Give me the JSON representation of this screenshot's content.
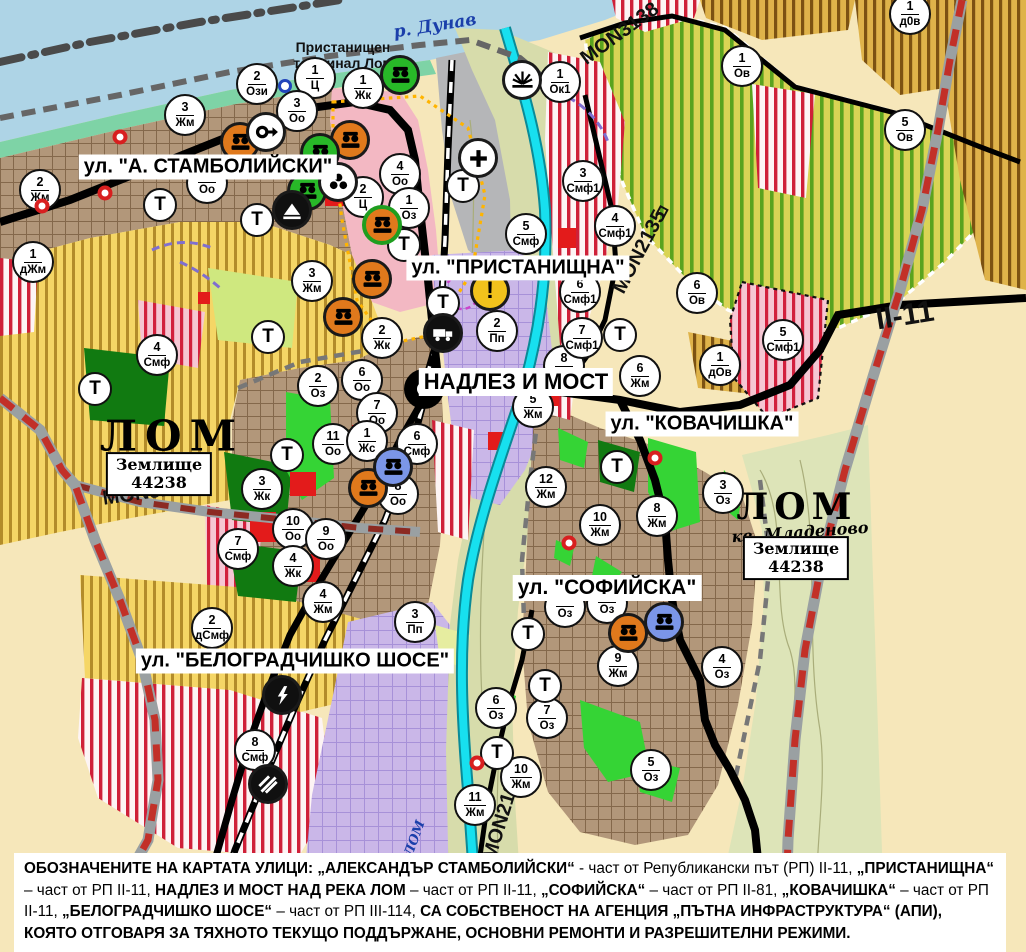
{
  "map": {
    "street_labels": [
      {
        "text": "ул. \"А. СТАМБОЛИЙСКИ\"",
        "x": 208,
        "y": 167
      },
      {
        "text": "ул. \"ПРИСТАНИЩНА\"",
        "x": 518,
        "y": 268
      },
      {
        "text": "НАДЛЕЗ И МОСТ",
        "x": 516,
        "y": 382
      },
      {
        "text": "ул. \"КОВАЧИШКА\"",
        "x": 702,
        "y": 424
      },
      {
        "text": "ул. \"СОФИЙСКА\"",
        "x": 607,
        "y": 588
      },
      {
        "text": "ул. \"БЕЛОГРАДЧИШКО ШОСЕ\"",
        "x": 295,
        "y": 661
      }
    ],
    "labels": [
      {
        "text": "р. Дунав",
        "x": 435,
        "y": 26,
        "cls": "river",
        "rot": -9,
        "size": 17
      },
      {
        "text": "Пристанищен\nтерминал Лом",
        "x": 343,
        "y": 55,
        "cls": "",
        "rot": 0,
        "size": 14
      },
      {
        "text": "ЛОМ",
        "x": 172,
        "y": 436,
        "cls": "city",
        "rot": 0,
        "size": 42,
        "ls": 8
      },
      {
        "text": "MON3139",
        "x": 148,
        "y": 493,
        "cls": "",
        "rot": -8,
        "size": 20
      },
      {
        "text": "MON3138",
        "x": 620,
        "y": 34,
        "cls": "",
        "rot": -36,
        "size": 20
      },
      {
        "text": "MON2135",
        "x": 640,
        "y": 252,
        "cls": "",
        "rot": -62,
        "size": 20
      },
      {
        "text": "⊓",
        "x": 662,
        "y": 212,
        "cls": "",
        "rot": 28,
        "size": 16
      },
      {
        "text": "II-11",
        "x": 905,
        "y": 316,
        "cls": "",
        "rot": -9,
        "size": 30
      },
      {
        "text": "ЛОМ",
        "x": 797,
        "y": 507,
        "cls": "city",
        "rot": 0,
        "size": 36,
        "ls": 6
      },
      {
        "text": "кв. Младеново",
        "x": 800,
        "y": 532,
        "cls": "city-sub",
        "rot": -4,
        "size": 16
      },
      {
        "text": "MON2136",
        "x": 503,
        "y": 816,
        "cls": "",
        "rot": -73,
        "size": 20
      },
      {
        "text": "р. ЛОМ",
        "x": 412,
        "y": 847,
        "cls": "river",
        "rot": -70,
        "size": 13
      }
    ],
    "land_boxes": [
      {
        "text": "Землище\n44238",
        "x": 159,
        "y": 474
      },
      {
        "text": "Землище\n44238",
        "x": 796,
        "y": 558
      }
    ],
    "t_label": "Т",
    "zone_markers": [
      {
        "num": "2",
        "code": "Жм",
        "x": 40,
        "y": 190
      },
      {
        "num": "3",
        "code": "Жм",
        "x": 185,
        "y": 115
      },
      {
        "num": "2",
        "code": "Ози",
        "x": 257,
        "y": 84
      },
      {
        "num": "1",
        "code": "Ц",
        "x": 315,
        "y": 78
      },
      {
        "num": "3",
        "code": "Оо",
        "x": 297,
        "y": 111
      },
      {
        "num": "1",
        "code": "Жк",
        "x": 363,
        "y": 88
      },
      {
        "num": "1",
        "code": "дЖм",
        "x": 33,
        "y": 262
      },
      {
        "num": "4",
        "code": "Оо",
        "x": 400,
        "y": 174
      },
      {
        "num": "2",
        "code": "Ц",
        "x": 363,
        "y": 197
      },
      {
        "num": "1",
        "code": "Оз",
        "x": 409,
        "y": 208
      },
      {
        "num": "",
        "code": "Оо",
        "x": 207,
        "y": 183,
        "under": true
      },
      {
        "num": "4",
        "code": "Смф",
        "x": 157,
        "y": 355
      },
      {
        "num": "3",
        "code": "Жм",
        "x": 312,
        "y": 281
      },
      {
        "num": "2",
        "code": "Жк",
        "x": 382,
        "y": 338
      },
      {
        "num": "2",
        "code": "Оз",
        "x": 318,
        "y": 386
      },
      {
        "num": "6",
        "code": "Оо",
        "x": 362,
        "y": 380
      },
      {
        "num": "7",
        "code": "Оо",
        "x": 377,
        "y": 413
      },
      {
        "num": "11",
        "code": "Оо",
        "x": 333,
        "y": 444
      },
      {
        "num": "1",
        "code": "Жс",
        "x": 367,
        "y": 441
      },
      {
        "num": "6",
        "code": "Смф",
        "x": 417,
        "y": 444
      },
      {
        "num": "3",
        "code": "Жк",
        "x": 262,
        "y": 489
      },
      {
        "num": "8",
        "code": "Оо",
        "x": 398,
        "y": 494
      },
      {
        "num": "10",
        "code": "Оо",
        "x": 293,
        "y": 529
      },
      {
        "num": "9",
        "code": "Оо",
        "x": 326,
        "y": 539
      },
      {
        "num": "7",
        "code": "Смф",
        "x": 238,
        "y": 549
      },
      {
        "num": "4",
        "code": "Жк",
        "x": 293,
        "y": 566
      },
      {
        "num": "4",
        "code": "Жм",
        "x": 323,
        "y": 602
      },
      {
        "num": "2",
        "code": "дСмф",
        "x": 212,
        "y": 628
      },
      {
        "num": "3",
        "code": "Пп",
        "x": 415,
        "y": 622
      },
      {
        "num": "8",
        "code": "Смф",
        "x": 255,
        "y": 750
      },
      {
        "num": "2",
        "code": "Пп",
        "x": 497,
        "y": 331
      },
      {
        "num": "5",
        "code": "Смф",
        "x": 526,
        "y": 234
      },
      {
        "num": "1",
        "code": "Ок1",
        "x": 560,
        "y": 82
      },
      {
        "num": "3",
        "code": "Смф1",
        "x": 583,
        "y": 181
      },
      {
        "num": "4",
        "code": "Смф1",
        "x": 615,
        "y": 226
      },
      {
        "num": "6",
        "code": "Смф1",
        "x": 580,
        "y": 292
      },
      {
        "num": "7",
        "code": "Смф1",
        "x": 582,
        "y": 338
      },
      {
        "num": "1",
        "code": "Ов",
        "x": 742,
        "y": 66
      },
      {
        "num": "5",
        "code": "Ов",
        "x": 905,
        "y": 130
      },
      {
        "num": "1",
        "code": "д0в",
        "x": 910,
        "y": 14
      },
      {
        "num": "6",
        "code": "Ов",
        "x": 697,
        "y": 293
      },
      {
        "num": "5",
        "code": "Смф1",
        "x": 783,
        "y": 340
      },
      {
        "num": "1",
        "code": "дОв",
        "x": 720,
        "y": 365
      },
      {
        "num": "8",
        "code": "Жм",
        "x": 564,
        "y": 366,
        "under": true
      },
      {
        "num": "5",
        "code": "Жм",
        "x": 533,
        "y": 407
      },
      {
        "num": "6",
        "code": "Жм",
        "x": 640,
        "y": 376
      },
      {
        "num": "12",
        "code": "Жм",
        "x": 546,
        "y": 487
      },
      {
        "num": "10",
        "code": "Жм",
        "x": 600,
        "y": 525
      },
      {
        "num": "8",
        "code": "Жм",
        "x": 657,
        "y": 516
      },
      {
        "num": "3",
        "code": "Оз",
        "x": 723,
        "y": 493
      },
      {
        "num": "9",
        "code": "Жм",
        "x": 618,
        "y": 666
      },
      {
        "num": "4",
        "code": "Оз",
        "x": 722,
        "y": 667
      },
      {
        "num": "6",
        "code": "Оз",
        "x": 496,
        "y": 708
      },
      {
        "num": "7",
        "code": "Оз",
        "x": 547,
        "y": 718
      },
      {
        "num": "5",
        "code": "Оз",
        "x": 651,
        "y": 770
      },
      {
        "num": "10",
        "code": "Жм",
        "x": 521,
        "y": 777
      },
      {
        "num": "11",
        "code": "Жм",
        "x": 475,
        "y": 805
      },
      {
        "num": "",
        "code": "Оз",
        "x": 565,
        "y": 607,
        "under": true
      },
      {
        "num": "",
        "code": "Оз",
        "x": 607,
        "y": 603,
        "under": true
      }
    ],
    "t_markers": [
      {
        "x": 160,
        "y": 205
      },
      {
        "x": 95,
        "y": 389
      },
      {
        "x": 257,
        "y": 220
      },
      {
        "x": 404,
        "y": 245
      },
      {
        "x": 268,
        "y": 337
      },
      {
        "x": 287,
        "y": 455
      },
      {
        "x": 443,
        "y": 303
      },
      {
        "x": 620,
        "y": 335
      },
      {
        "x": 463,
        "y": 186
      },
      {
        "x": 617,
        "y": 467
      },
      {
        "x": 528,
        "y": 634
      },
      {
        "x": 545,
        "y": 686
      },
      {
        "x": 497,
        "y": 753
      }
    ],
    "poi": [
      {
        "type": "monument-orange",
        "x": 240,
        "y": 142
      },
      {
        "type": "monument-orange",
        "x": 350,
        "y": 140
      },
      {
        "type": "monument-orange",
        "x": 372,
        "y": 279
      },
      {
        "type": "monument-orange",
        "x": 343,
        "y": 317
      },
      {
        "type": "monument-orange",
        "x": 368,
        "y": 488
      },
      {
        "type": "monument-orange",
        "x": 628,
        "y": 633
      },
      {
        "type": "monument-orange-greenring",
        "x": 382,
        "y": 225
      },
      {
        "type": "monument-green",
        "x": 400,
        "y": 75
      },
      {
        "type": "monument-green",
        "x": 320,
        "y": 153
      },
      {
        "type": "monument-green",
        "x": 307,
        "y": 191
      },
      {
        "type": "monument-blue",
        "x": 393,
        "y": 467
      },
      {
        "type": "monument-blue",
        "x": 664,
        "y": 622
      },
      {
        "type": "key",
        "x": 266,
        "y": 132
      },
      {
        "type": "trefoil",
        "x": 338,
        "y": 182
      },
      {
        "type": "arch",
        "x": 292,
        "y": 210
      },
      {
        "type": "fan",
        "x": 522,
        "y": 80
      },
      {
        "type": "cross",
        "x": 478,
        "y": 158
      },
      {
        "type": "truck",
        "x": 443,
        "y": 333
      },
      {
        "type": "warning",
        "x": 490,
        "y": 291
      },
      {
        "type": "lightning",
        "x": 282,
        "y": 695
      },
      {
        "type": "rail-crossing",
        "x": 268,
        "y": 784
      }
    ],
    "blue_rings": [
      {
        "x": 285,
        "y": 86
      }
    ],
    "red_dots": [
      {
        "x": 120,
        "y": 137
      },
      {
        "x": 105,
        "y": 193
      },
      {
        "x": 42,
        "y": 206
      },
      {
        "x": 569,
        "y": 543
      },
      {
        "x": 655,
        "y": 458
      },
      {
        "x": 477,
        "y": 763
      }
    ],
    "palette": {
      "water": "#aed4e6",
      "shore_green": "#7ed3a6",
      "urban_brown": "#b2977a",
      "vineyard_yellow": "#f5d666",
      "orchard_green_stripe": "#5aa31e",
      "orchard_bg": "#d9d455",
      "mixed_red_stripe": "#cf2038",
      "center_pink": "#f3b8c3",
      "production_lavender": "#cab7e8",
      "floodplain_khaki": "#d7dcab",
      "park_dark_green": "#117a11",
      "landscaping_green": "#35d435",
      "river_cyan": "#17e0ef",
      "road_black": "#000000",
      "republican_road_red": "#c23028",
      "heritage_boundary_orange": "#ffb400",
      "port_gray": "#b5b6b8",
      "red_patch": "#e31b1b"
    }
  },
  "caption": {
    "segments": [
      {
        "text": "ОБОЗНАЧЕНИТЕ НА КАРТАТА УЛИЦИ: ",
        "bold": true
      },
      {
        "text": "„АЛЕКСАНДЪР СТАМБОЛИЙСКИ“",
        "bold": true
      },
      {
        "text": " - част от Републикански път (РП) II-11, ",
        "bold": false
      },
      {
        "text": "„ПРИСТАНИЩНА“",
        "bold": true
      },
      {
        "text": " – част от РП II-11, ",
        "bold": false
      },
      {
        "text": "НАДЛЕЗ И МОСТ НАД РЕКА ЛОМ",
        "bold": true
      },
      {
        "text": " – част от РП II-11, ",
        "bold": false
      },
      {
        "text": "„СОФИЙСКА“",
        "bold": true
      },
      {
        "text": " – част от РП II-81, ",
        "bold": false
      },
      {
        "text": "„КОВАЧИШКА“",
        "bold": true
      },
      {
        "text": " – част от РП II-11, ",
        "bold": false
      },
      {
        "text": "„БЕЛОГРАДЧИШКО ШОСЕ“",
        "bold": true
      },
      {
        "text": " – част от РП III-114, ",
        "bold": false
      },
      {
        "text": "СА СОБСТВЕНОСТ НА АГЕНЦИЯ „ПЪТНА ИНФРАСТРУКТУРА“ (АПИ), КОЯТО ОТГОВАРЯ ЗА ТЯХНОТО ТЕКУЩО ПОДДЪРЖАНЕ, ОСНОВНИ РЕМОНТИ И РАЗРЕШИТЕЛНИ РЕЖИМИ.",
        "bold": true
      }
    ]
  }
}
